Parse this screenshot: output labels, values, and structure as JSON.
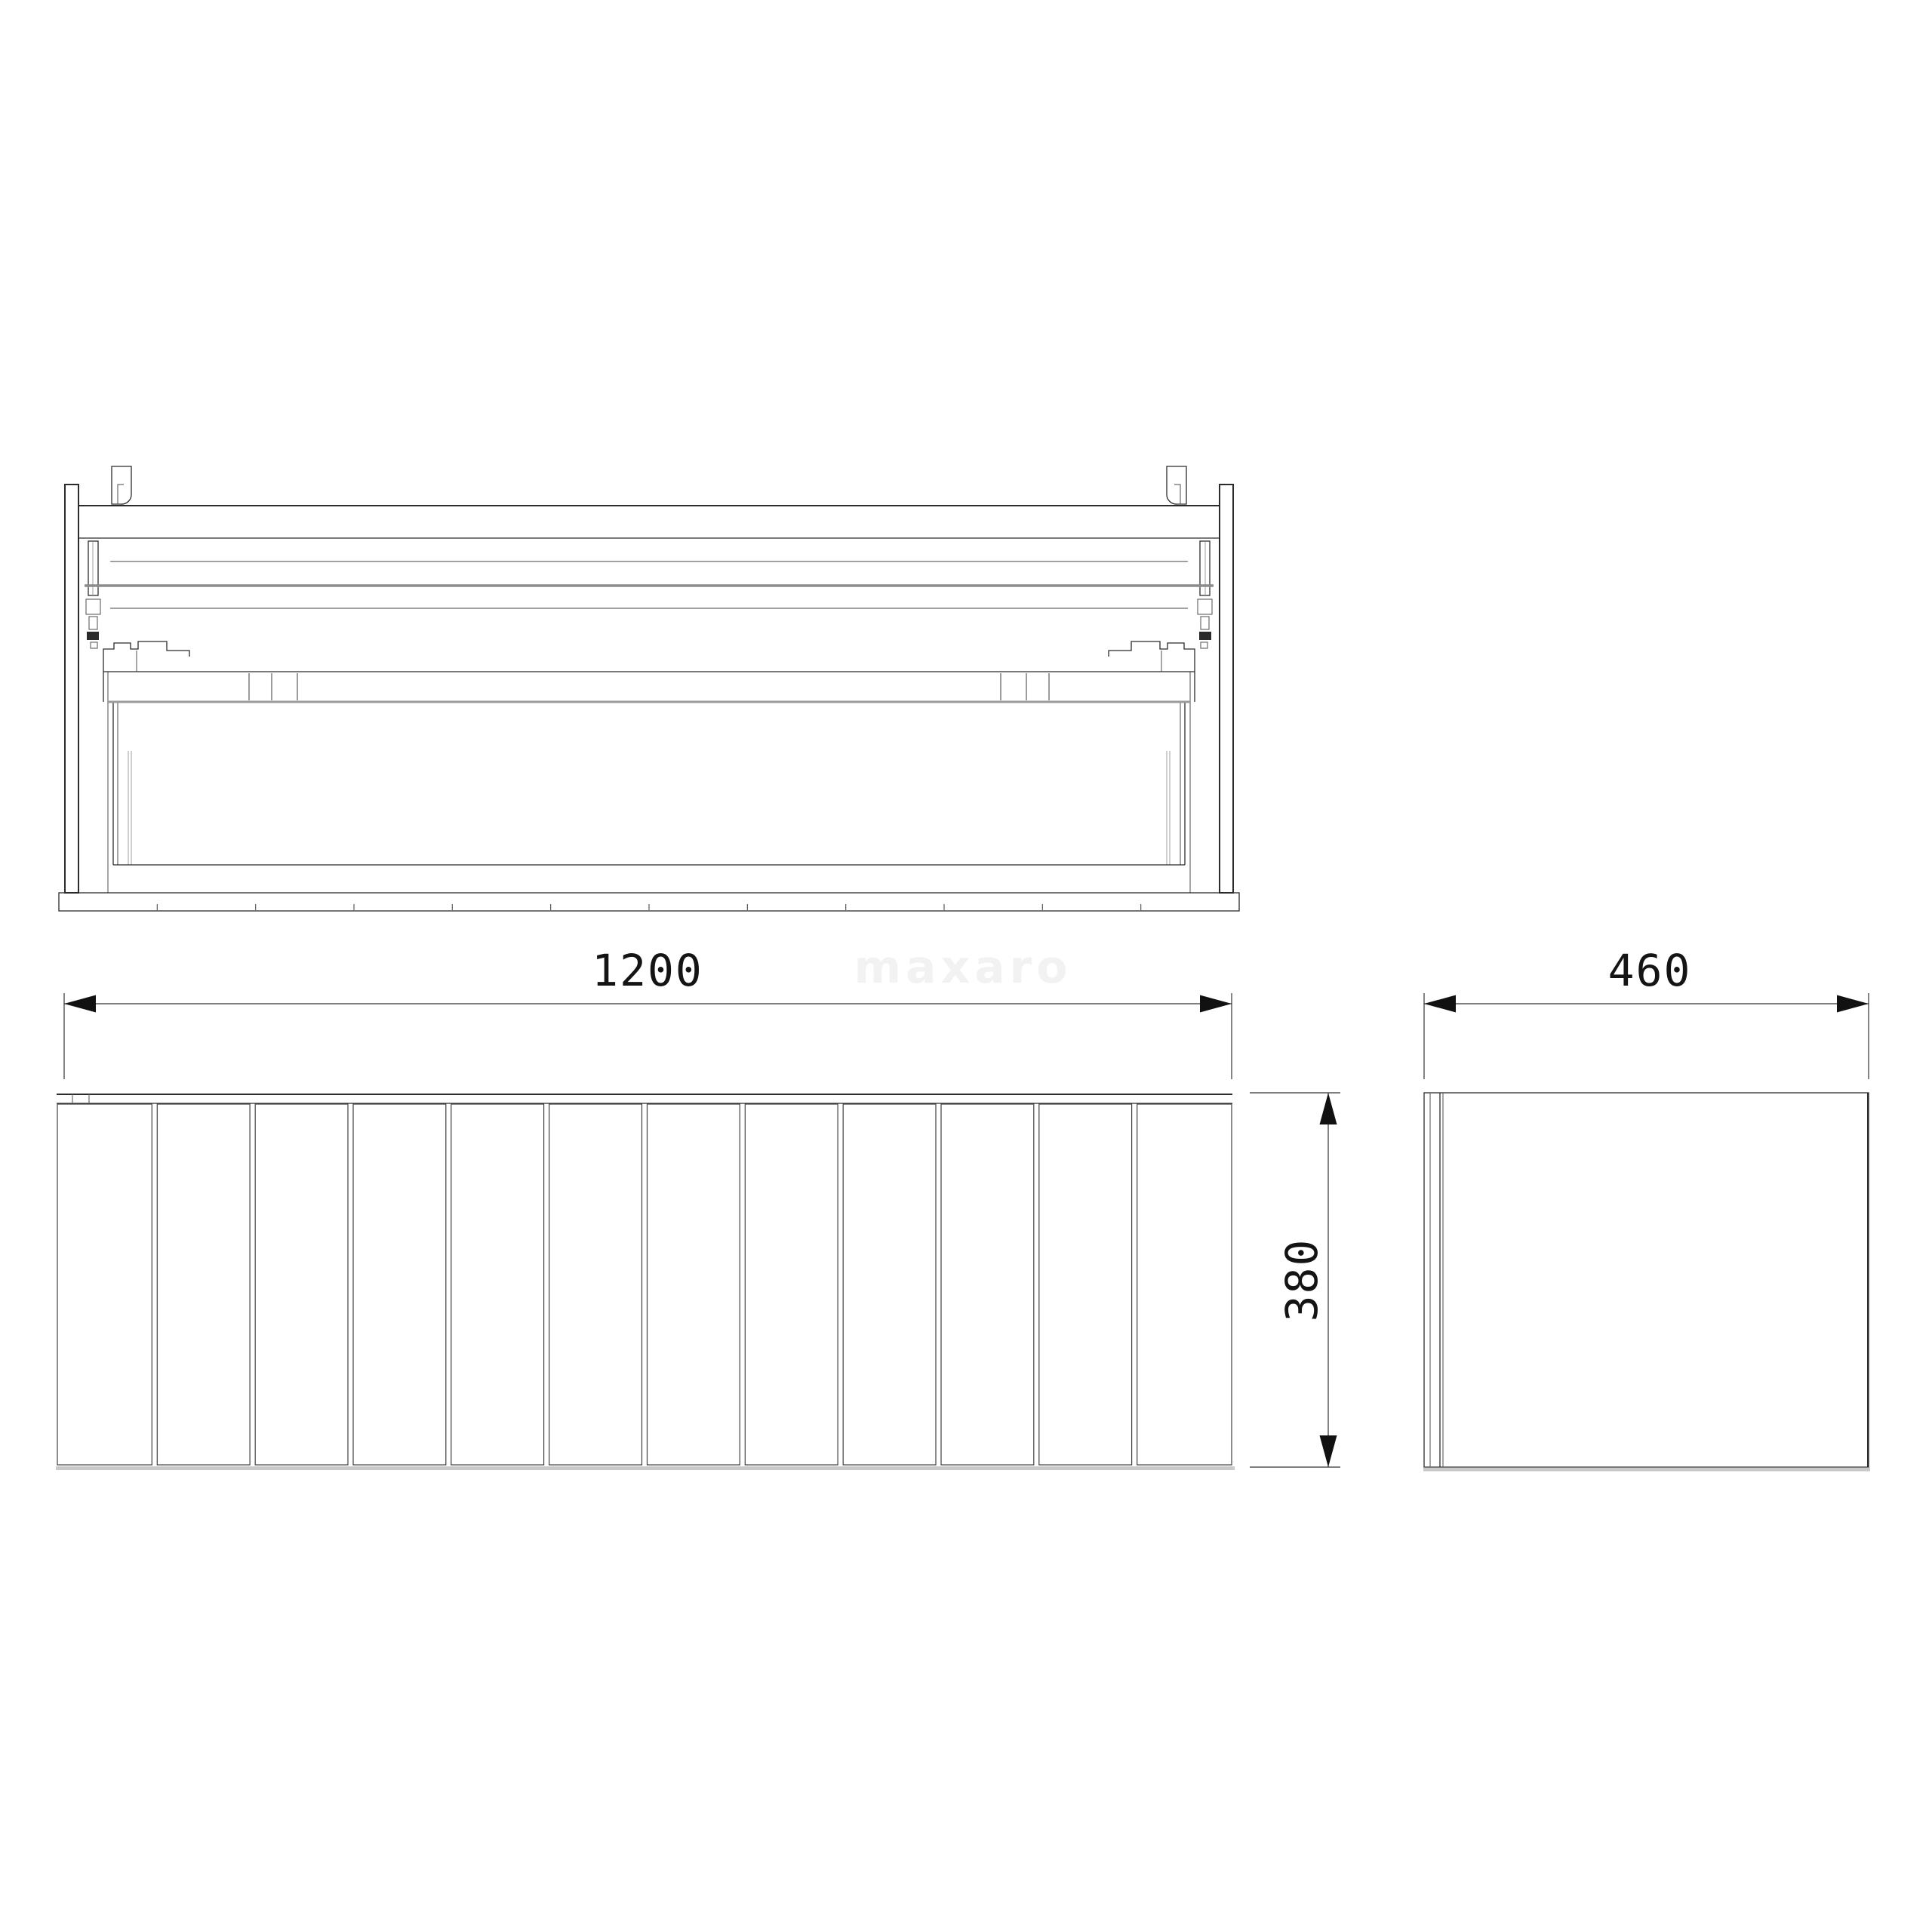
{
  "watermark": {
    "text": "maxaro",
    "color": "#f2f2f2"
  },
  "dimensions": {
    "width": {
      "label": "1200"
    },
    "depth": {
      "label": "460"
    },
    "height": {
      "label": "380"
    }
  },
  "front_view": {
    "slat_count": 12
  },
  "line_colors": {
    "primary": "#2b2b2b",
    "medium": "#6b6b6b",
    "light": "#9c9c9c",
    "shadow": "#c9c9c9",
    "background": "#ffffff"
  }
}
